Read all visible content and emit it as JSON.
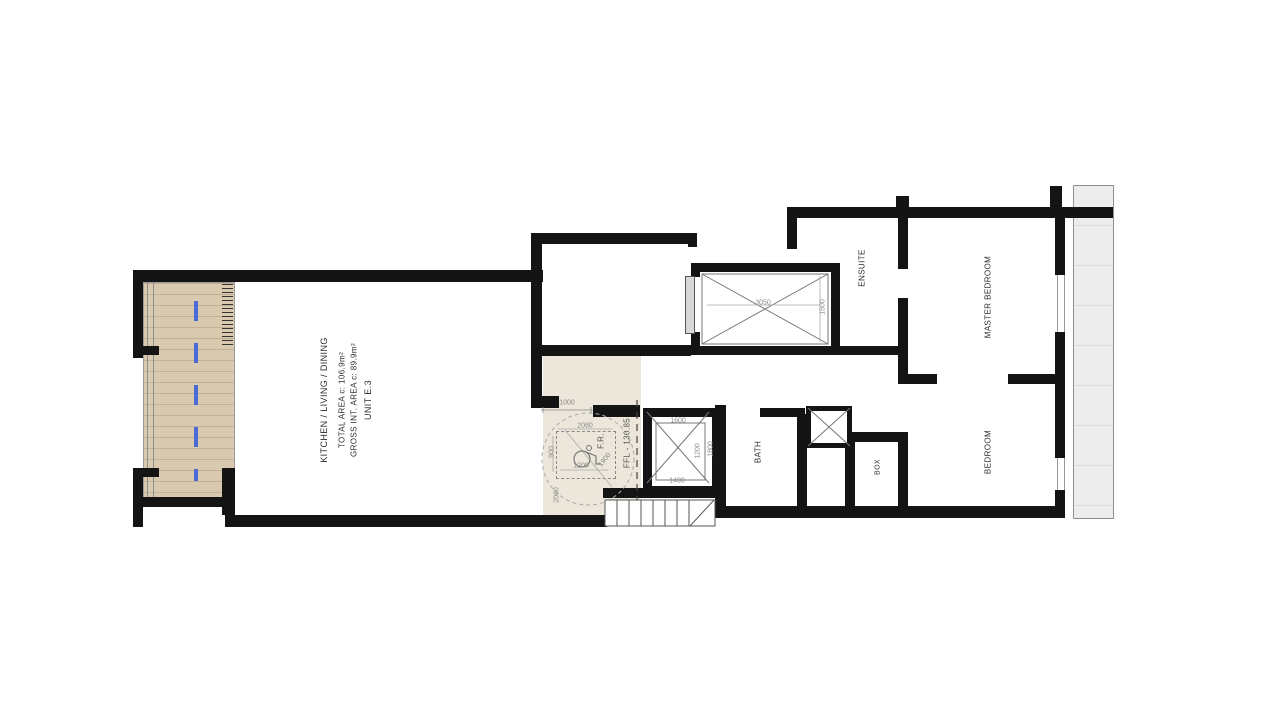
{
  "unit": {
    "name": "UNIT E.3",
    "gross_area": "GROSS INT. AREA c: 89.9m²",
    "total_area": "TOTAL AREA c: 106.9m²",
    "main_room": "KITCHEN / LIVING / DINING"
  },
  "rooms": {
    "ensuite": "ENSUITE",
    "master_bedroom": "MASTER BEDROOM",
    "bedroom": "BEDROOM",
    "bath": "BATH",
    "box": "BOX"
  },
  "levels": {
    "ffl": "FFL - 130.85"
  },
  "annotations": {
    "fire_riser": "F.R."
  },
  "dimensions": {
    "shaft_width": "3050",
    "shaft_depth": "1500",
    "entry_opening": "1000",
    "fr_zone_width": "2080",
    "fr_zone_depth": "900",
    "fr_inner_width": "1200",
    "turning_circle": "1900",
    "lift_width": "1600",
    "lift_door": "1400",
    "lift_depth": "1200",
    "lift_shaft_depth": "1800",
    "lobby_depth": "2080"
  },
  "colors": {
    "wall": "#141414",
    "terrace_fill": "#d8c9af",
    "terrace_stripe": "#c3b196",
    "lobby_fill": "#ece7da",
    "party_wall_fill": "#ededed",
    "axis_blue": "#4a6bd6",
    "dim_text": "#8a8a8a",
    "label_text": "#2b2b2b"
  }
}
